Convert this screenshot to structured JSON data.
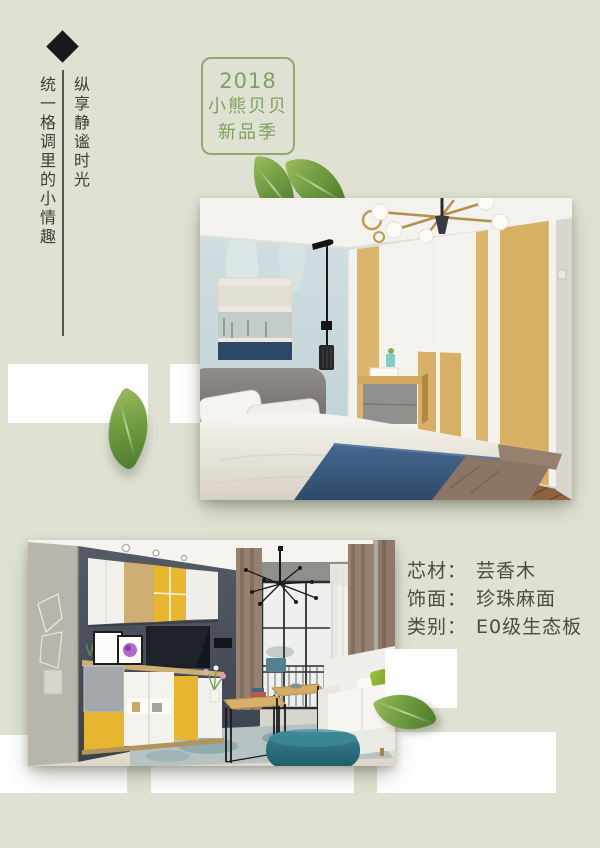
{
  "colors": {
    "background": "#dfe2d2",
    "badge_green": "#7fa05f",
    "text_dark": "#4c4c45",
    "slogan_dark": "#3e3e38",
    "leaf_green": "#74a043",
    "accent_yellow": "#e7b52f",
    "accent_teal": "#2f7886",
    "tile_white": "#fefefe"
  },
  "badge": {
    "year": "2018",
    "brand": "小熊贝贝",
    "season": "新品季"
  },
  "slogan": {
    "main": "纵享静谧时光",
    "sub": "统一格调里的小情趣"
  },
  "specs": {
    "colon": "：",
    "items": [
      {
        "label": "芯材",
        "value": "芸香木"
      },
      {
        "label": "饰面",
        "value": "珍珠麻面"
      },
      {
        "label": "类别",
        "value": "E0级生态板"
      }
    ]
  }
}
